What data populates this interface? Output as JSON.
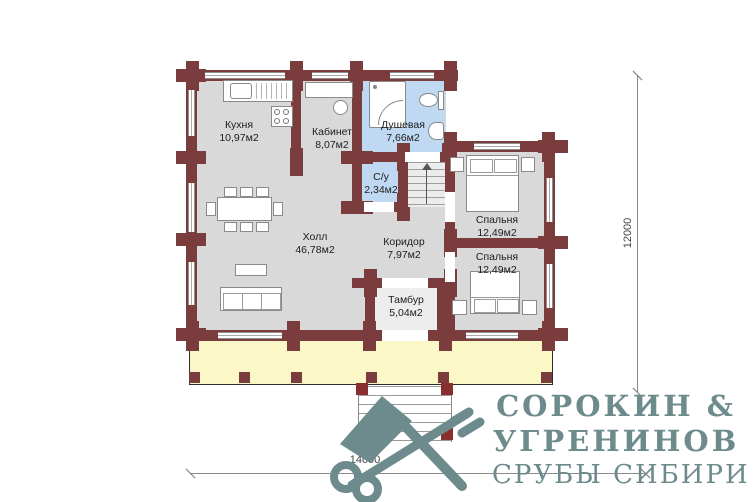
{
  "plan": {
    "rooms": [
      {
        "name": "Кухня",
        "area": "10,97м2"
      },
      {
        "name": "Кабинет",
        "area": "8,07м2"
      },
      {
        "name": "Душевая",
        "area": "7,66м2"
      },
      {
        "name": "С/у",
        "area": "2,34м2"
      },
      {
        "name": "Холл",
        "area": "46,78м2"
      },
      {
        "name": "Коридор",
        "area": "7,97м2"
      },
      {
        "name": "Тамбур",
        "area": "5,04м2"
      },
      {
        "name": "Спальня",
        "area": "12,49м2"
      },
      {
        "name": "Спальня",
        "area": "12,49м2"
      }
    ],
    "dimensions": {
      "vertical": "12000",
      "horizontal": "14000"
    },
    "colors": {
      "wall": "#7a3c3c",
      "floor": "#d9d9d9",
      "wet_floor": "#bed9f1",
      "terrace": "#fbf7c7",
      "logo": "#6d8b8c"
    }
  },
  "logo": {
    "name_line1": "СОРОКИН &",
    "name_line2": "УГРЕНИНОВ",
    "tagline": "СРУБЫ СИБИРИ",
    "icon": "crossed-axe-and-key-icon"
  }
}
